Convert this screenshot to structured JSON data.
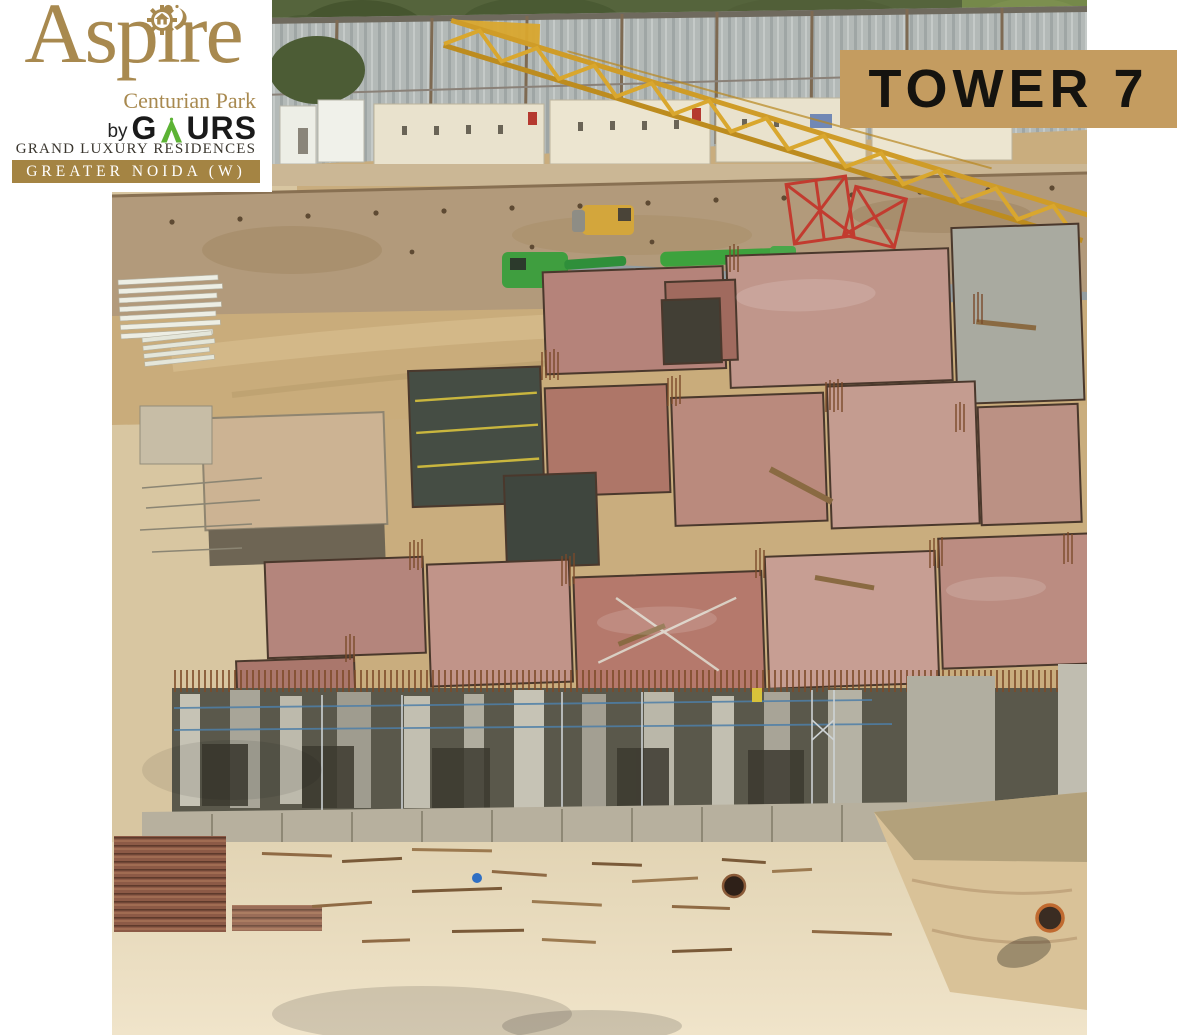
{
  "brand_card": {
    "brand": "Aspire",
    "subtitle": "Centurian Park",
    "by_label": "by",
    "developer_prefix": "G",
    "developer_suffix": "URS",
    "tagline": "GRAND LUXURY RESIDENCES",
    "location": "GREATER NOIDA (W)"
  },
  "tower_badge": {
    "label": "TOWER 7"
  },
  "colors": {
    "brand_gold": "#a8894f",
    "bar_gold": "#a48443",
    "badge_tan": "#c49c60",
    "badge_text": "#15130f",
    "gaurs_green": "#5cb335",
    "tagline_dark": "#3a362e"
  }
}
